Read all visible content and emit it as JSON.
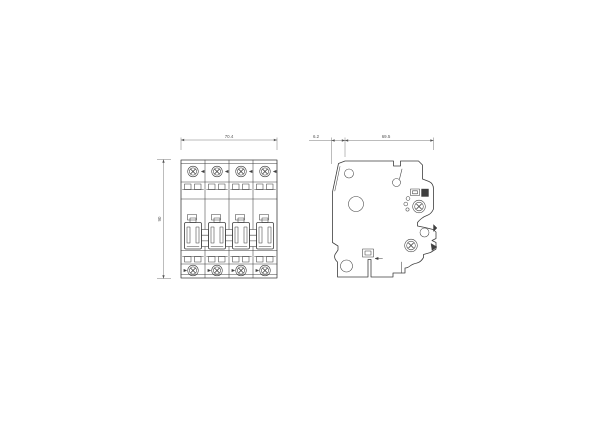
{
  "drawing": {
    "background_color": "#ffffff",
    "stroke_color": "#3f3f3f",
    "dimension_color": "#6a6a6a",
    "front_view": {
      "width_label": "70.4",
      "height_label": "90"
    },
    "side_view": {
      "offset_label": "6.2",
      "depth_label": "69.5"
    }
  }
}
